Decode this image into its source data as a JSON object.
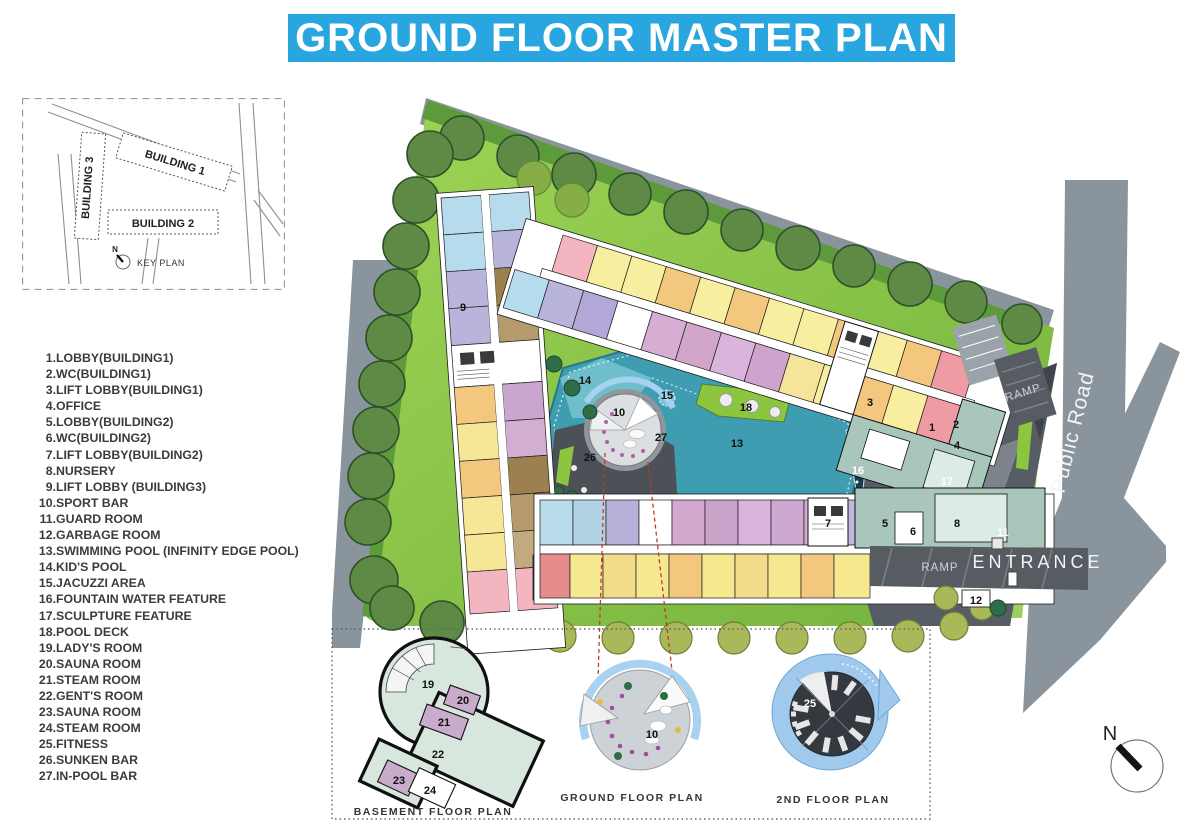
{
  "title": "GROUND FLOOR MASTER PLAN",
  "key_plan": {
    "caption": "KEY PLAN",
    "north": "N",
    "building1": "BUILDING 1",
    "building2": "BUILDING 2",
    "building3": "BUILDING 3"
  },
  "legend": {
    "items": [
      {
        "n": "1.",
        "t": "LOBBY(BUILDING1)"
      },
      {
        "n": "2.",
        "t": "WC(BUILDING1)"
      },
      {
        "n": "3.",
        "t": "LIFT LOBBY(BUILDING1)"
      },
      {
        "n": "4.",
        "t": "OFFICE"
      },
      {
        "n": "5.",
        "t": "LOBBY(BUILDING2)"
      },
      {
        "n": "6.",
        "t": "WC(BUILDING2)"
      },
      {
        "n": "7.",
        "t": "LIFT LOBBY(BUILDING2)"
      },
      {
        "n": "8.",
        "t": "NURSERY"
      },
      {
        "n": "9.",
        "t": "LIFT LOBBY (BUILDING3)"
      },
      {
        "n": "10.",
        "t": "SPORT BAR"
      },
      {
        "n": "11.",
        "t": "GUARD ROOM"
      },
      {
        "n": "12.",
        "t": "GARBAGE ROOM"
      },
      {
        "n": "13.",
        "t": "SWIMMING POOL (INFINITY EDGE POOL)"
      },
      {
        "n": "14.",
        "t": "KID'S POOL"
      },
      {
        "n": "15.",
        "t": "JACUZZI AREA"
      },
      {
        "n": "16.",
        "t": "FOUNTAIN WATER FEATURE"
      },
      {
        "n": "17.",
        "t": "SCULPTURE FEATURE"
      },
      {
        "n": "18.",
        "t": "POOL DECK"
      },
      {
        "n": "19.",
        "t": "LADY'S ROOM"
      },
      {
        "n": "20.",
        "t": "SAUNA ROOM"
      },
      {
        "n": "21.",
        "t": "STEAM ROOM"
      },
      {
        "n": "22.",
        "t": "GENT'S ROOM"
      },
      {
        "n": "23.",
        "t": "SAUNA ROOM"
      },
      {
        "n": "24.",
        "t": "STEAM ROOM"
      },
      {
        "n": "25.",
        "t": "FITNESS"
      },
      {
        "n": "26.",
        "t": "SUNKEN BAR"
      },
      {
        "n": "27.",
        "t": "IN-POOL BAR"
      }
    ]
  },
  "site": {
    "public_road": "Public Road",
    "entrance": "ENTRANCE",
    "ramp_upper": "RAMP",
    "ramp_lower": "RAMP",
    "north": "N",
    "markers": {
      "m1": "1",
      "m2": "2",
      "m3": "3",
      "m4": "4",
      "m5": "5",
      "m6": "6",
      "m7": "7",
      "m8": "8",
      "m9": "9",
      "m10": "10",
      "m11": "11",
      "m12": "12",
      "m13": "13",
      "m14": "14",
      "m15": "15",
      "m16": "16",
      "m17": "17",
      "m18": "18",
      "m26": "26",
      "m27": "27"
    }
  },
  "details": {
    "basement": {
      "caption": "BASEMENT FLOOR PLAN",
      "rooms": {
        "r19": "19",
        "r20": "20",
        "r21": "21",
        "r22": "22",
        "r23": "23",
        "r24": "24"
      }
    },
    "ground": {
      "caption": "GROUND FLOOR PLAN",
      "marker": "10"
    },
    "second": {
      "caption": "2ND FLOOR PLAN",
      "marker": "25"
    }
  },
  "colors": {
    "banner": "#29a6df",
    "road": "#8a949c",
    "lawn": "#8cc63f",
    "pool": "#3e9db0",
    "plaza": "#575d64"
  }
}
